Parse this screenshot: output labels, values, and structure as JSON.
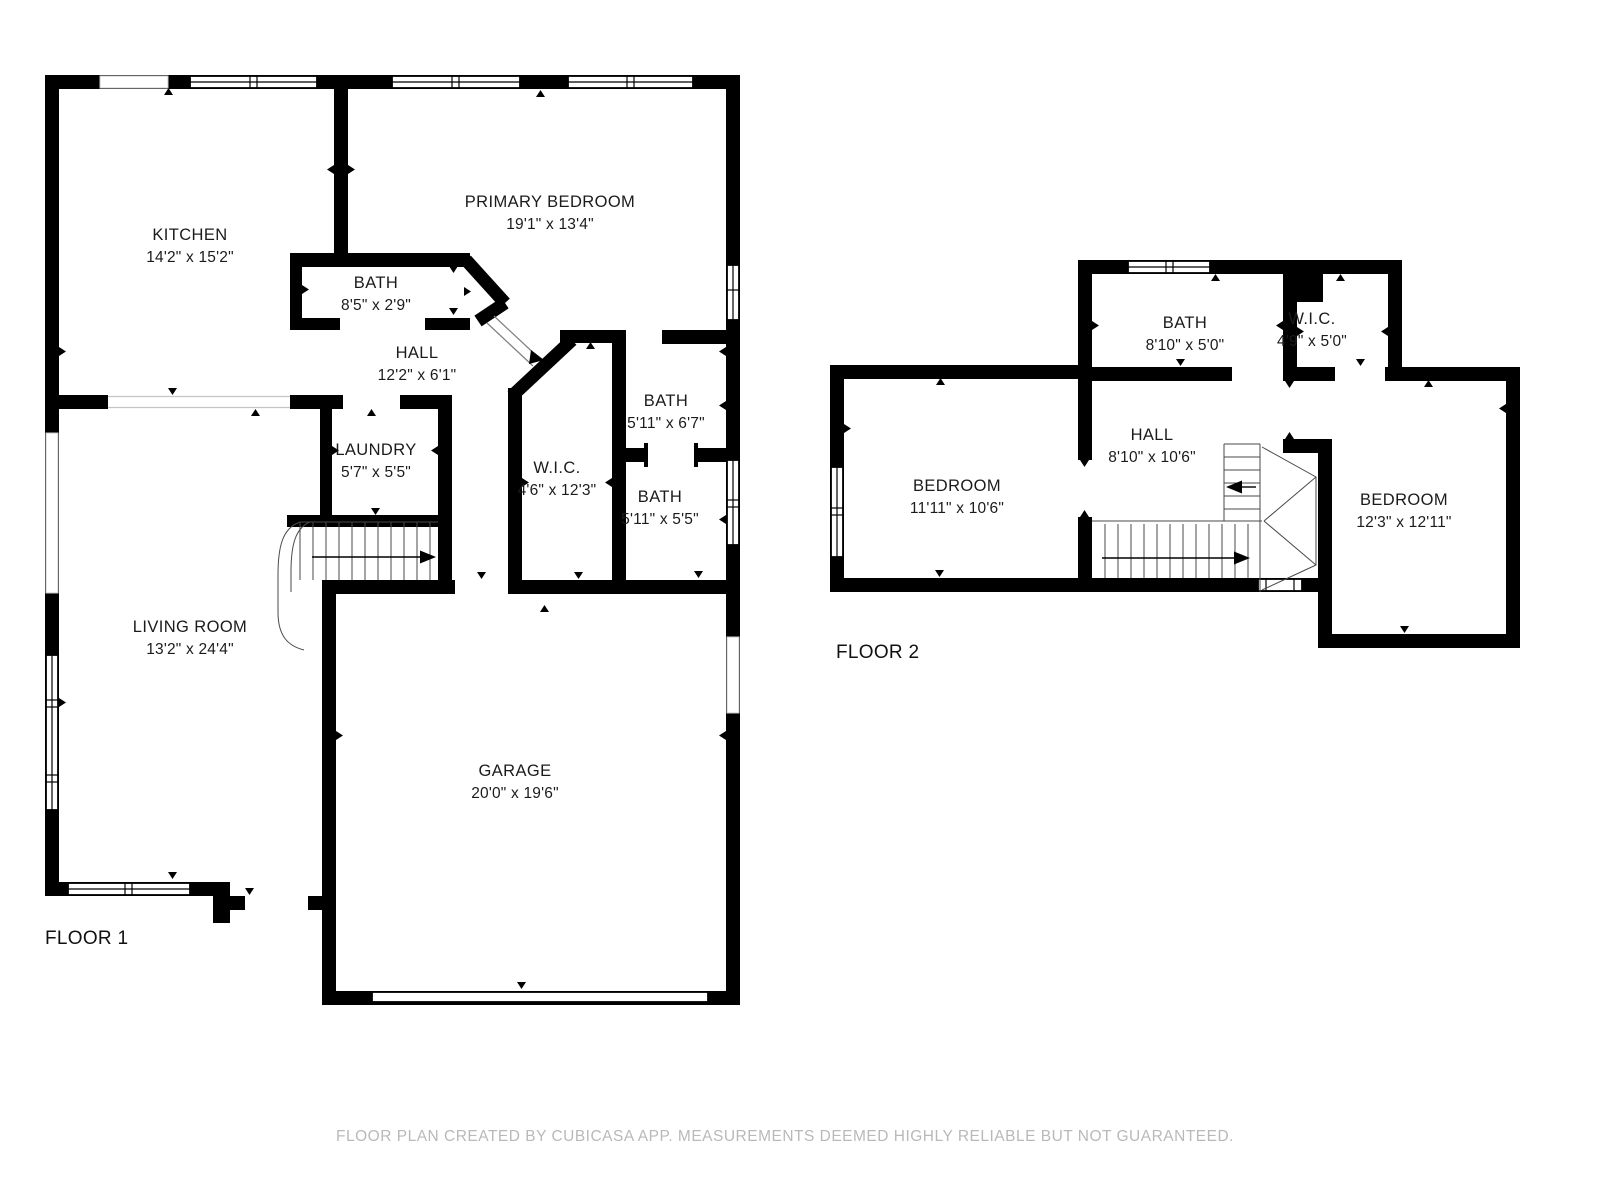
{
  "colors": {
    "wall": "#000000",
    "label_text": "#1b1b1b",
    "disclaimer_text": "#b9b9b9",
    "background": "#ffffff"
  },
  "floor1": {
    "label": "FLOOR 1",
    "rooms": {
      "kitchen": {
        "name": "KITCHEN",
        "dims": "14'2\" x 15'2\""
      },
      "primary_bedroom": {
        "name": "PRIMARY BEDROOM",
        "dims": "19'1\" x 13'4\""
      },
      "bath_a": {
        "name": "BATH",
        "dims": "8'5\" x 2'9\""
      },
      "hall": {
        "name": "HALL",
        "dims": "12'2\" x 6'1\""
      },
      "laundry": {
        "name": "LAUNDRY",
        "dims": "5'7\" x 5'5\""
      },
      "wic": {
        "name": "W.I.C.",
        "dims": "4'6\" x 12'3\""
      },
      "bath_b": {
        "name": "BATH",
        "dims": "5'11\" x 6'7\""
      },
      "bath_c": {
        "name": "BATH",
        "dims": "5'11\" x 5'5\""
      },
      "living_room": {
        "name": "LIVING ROOM",
        "dims": "13'2\" x 24'4\""
      },
      "garage": {
        "name": "GARAGE",
        "dims": "20'0\" x 19'6\""
      }
    }
  },
  "floor2": {
    "label": "FLOOR 2",
    "rooms": {
      "bath": {
        "name": "BATH",
        "dims": "8'10\" x 5'0\""
      },
      "wic": {
        "name": "W.I.C.",
        "dims": "4'9\" x 5'0\""
      },
      "hall": {
        "name": "HALL",
        "dims": "8'10\" x 10'6\""
      },
      "bedroom_1": {
        "name": "BEDROOM",
        "dims": "11'11\" x 10'6\""
      },
      "bedroom_2": {
        "name": "BEDROOM",
        "dims": "12'3\" x 12'11\""
      }
    }
  },
  "footer": {
    "disclaimer": "FLOOR PLAN CREATED BY CUBICASA APP. MEASUREMENTS DEEMED HIGHLY RELIABLE BUT NOT GUARANTEED."
  }
}
